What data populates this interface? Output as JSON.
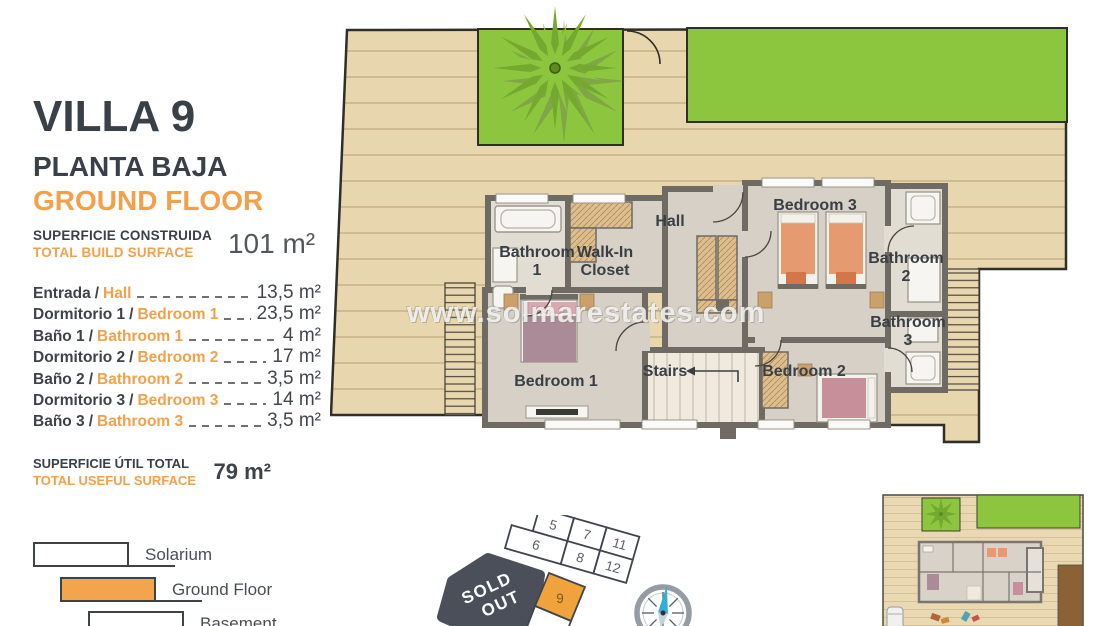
{
  "panel": {
    "title": "VILLA 9",
    "subtitle_es": "PLANTA BAJA",
    "subtitle_en": "GROUND FLOOR",
    "separator": "/",
    "build": {
      "label_es": "SUPERFICIE CONSTRUIDA",
      "label_en": "TOTAL BUILD SURFACE",
      "value": "101 m²"
    },
    "rooms": [
      {
        "es": "Entrada",
        "en": "Hall",
        "area": "13,5 m²"
      },
      {
        "es": "Dormitorio 1",
        "en": "Bedroom 1",
        "area": "23,5 m²"
      },
      {
        "es": "Baño 1",
        "en": "Bathroom 1",
        "area": "4 m²"
      },
      {
        "es": "Dormitorio 2",
        "en": "Bedroom 2",
        "area": "17 m²"
      },
      {
        "es": "Baño 2",
        "en": "Bathroom 2",
        "area": "3,5 m²"
      },
      {
        "es": "Dormitorio 3",
        "en": "Bedroom 3",
        "area": "14 m²"
      },
      {
        "es": "Baño 3",
        "en": "Bathroom 3",
        "area": "3,5 m²"
      }
    ],
    "useful": {
      "label_es": "SUPERFICIE ÚTIL TOTAL",
      "label_en": "TOTAL USEFUL SURFACE",
      "value": "79 m²"
    },
    "legend": [
      {
        "label": "Solarium"
      },
      {
        "label": "Ground Floor"
      },
      {
        "label": "Basement"
      }
    ]
  },
  "plan": {
    "watermark": "www.solmarestates.com",
    "labels": {
      "bathroom1": "Bathroom 1",
      "walk_in_closet": "Walk-In Closet",
      "hall": "Hall",
      "bedroom3": "Bedroom 3",
      "bathroom2": "Bathroom 2",
      "bathroom3": "Bathroom 3",
      "bedroom2": "Bedroom 2",
      "bedroom1": "Bedroom 1",
      "stairs": "Stairs"
    }
  },
  "site_plan": {
    "plots": [
      "5",
      "7",
      "11",
      "6",
      "8",
      "12",
      "9",
      "10"
    ],
    "sold_out_line1": "SOLD",
    "sold_out_line2": "OUT",
    "highlighted_plot": "9",
    "highlight_color": "#F0A23C"
  },
  "colors": {
    "accent_orange": "#F2A14A",
    "heading_dark": "#3A4048",
    "deck": "#E8D6AF",
    "lawn": "#8CC63F",
    "wall": "#6F6A63",
    "sold_out": "#4A4F59",
    "compass_needle": "#33AFD6"
  }
}
